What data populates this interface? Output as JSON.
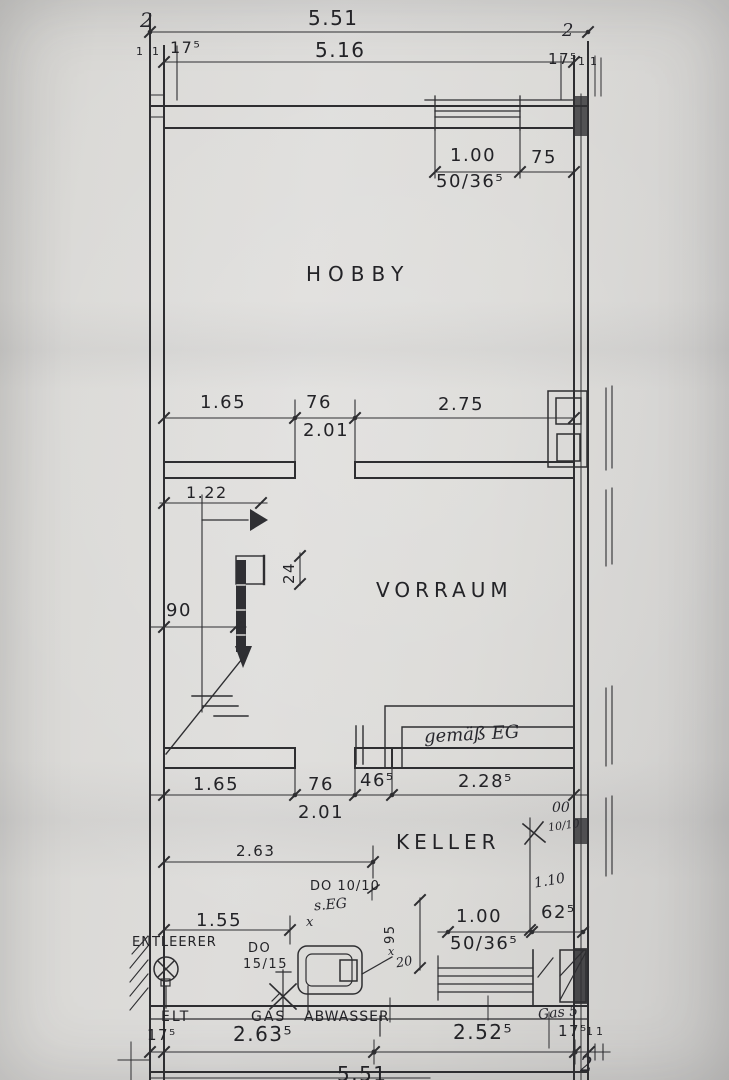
{
  "colors": {
    "paper": "#d8d7d4",
    "ink": "#2e2e31"
  },
  "rooms": {
    "hobby": "HOBBY",
    "vorraum": "VORRAUM",
    "keller": "KELLER"
  },
  "top_dims": {
    "corner_left": "2",
    "overall": "5.51",
    "inner": "5.16",
    "wall_left": "17⁵",
    "wall_right": "17⁵",
    "corner_right": "2",
    "tick_1a": "1",
    "tick_1b": "1",
    "tick_1c": "1",
    "tick_1d": "1"
  },
  "window_top": {
    "width": "1.00",
    "right_offset": "75",
    "spec": "50/36⁵"
  },
  "hobby_dims": {
    "left": "1.65",
    "door_width": "76",
    "right": "2.75",
    "door_height": "2.01"
  },
  "stair_dims": {
    "width": "1.22",
    "column": "24",
    "offset": "90"
  },
  "wall_note": "gemäß EG",
  "keller_dims": {
    "left": "1.65",
    "door_width": "76",
    "pier": "46⁵",
    "right": "2.28⁵",
    "door_height": "2.01",
    "room_length": "2.63",
    "hand_00": "00",
    "hand_duct": "10/10",
    "hand_height": "1.10",
    "sill": "62⁵"
  },
  "window_bottom": {
    "width": "1.00",
    "spec": "50/36⁵",
    "depth": "95",
    "hand_20": "20",
    "hand_x_a": "x",
    "hand_x_b": "x",
    "duct_label": "DO 10/10",
    "note": "s.EG"
  },
  "services": {
    "drain_dim": "1.55",
    "drain_label": "ENTLEERER",
    "duct_do": "DO",
    "duct_size": "15/15",
    "elt": "ELT",
    "gas": "GAS",
    "abwasser": "ABWASSER"
  },
  "bottom_dims": {
    "wall_left": "17⁵",
    "left": "2.63⁵",
    "right": "2.52⁵",
    "hand_gas": "Gas 5",
    "wall_right": "17⁵",
    "tick_1a": "1",
    "tick_1b": "1",
    "corner": "2",
    "overall": "5.51"
  }
}
